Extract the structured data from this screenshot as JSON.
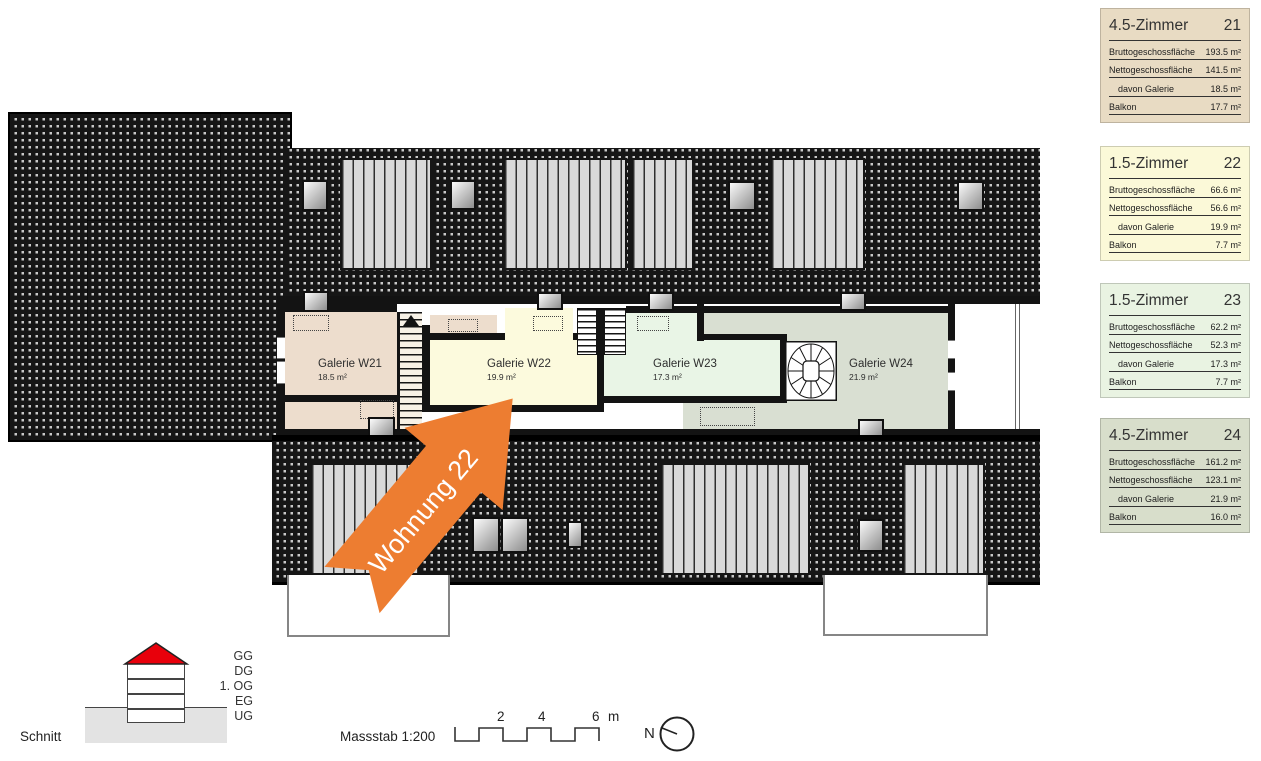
{
  "plan": {
    "galleries": [
      {
        "name": "Galerie W21",
        "area": "18.5 m²",
        "color": "#edddcd"
      },
      {
        "name": "Galerie W22",
        "area": "19.9 m²",
        "color": "#fcfadd"
      },
      {
        "name": "Galerie W23",
        "area": "17.3 m²",
        "color": "#e9f5e6"
      },
      {
        "name": "Galerie W24",
        "area": "21.9 m²",
        "color": "#d9dfd2"
      }
    ],
    "arrow": {
      "label": "Wohnung 22",
      "color": "#ED7D31"
    }
  },
  "cards": [
    {
      "type": "4.5-Zimmer",
      "number": "21",
      "bg": "#e8dbc3",
      "rows": [
        {
          "label": "Bruttogeschossfläche",
          "value": "193.5 m²"
        },
        {
          "label": "Nettogeschossfläche",
          "value": "141.5 m²"
        },
        {
          "label": "davon Galerie",
          "value": "18.5 m²"
        },
        {
          "label": "Balkon",
          "value": "17.7 m²"
        }
      ]
    },
    {
      "type": "1.5-Zimmer",
      "number": "22",
      "bg": "#fbf9d8",
      "rows": [
        {
          "label": "Bruttogeschossfläche",
          "value": "66.6 m²"
        },
        {
          "label": "Nettogeschossfläche",
          "value": "56.6 m²"
        },
        {
          "label": "davon Galerie",
          "value": "19.9 m²"
        },
        {
          "label": "Balkon",
          "value": "7.7 m²"
        }
      ]
    },
    {
      "type": "1.5-Zimmer",
      "number": "23",
      "bg": "#e9f3e2",
      "rows": [
        {
          "label": "Bruttogeschossfläche",
          "value": "62.2 m²"
        },
        {
          "label": "Nettogeschossfläche",
          "value": "52.3 m²"
        },
        {
          "label": "davon Galerie",
          "value": "17.3 m²"
        },
        {
          "label": "Balkon",
          "value": "7.7 m²"
        }
      ]
    },
    {
      "type": "4.5-Zimmer",
      "number": "24",
      "bg": "#d8decb",
      "rows": [
        {
          "label": "Bruttogeschossfläche",
          "value": "161.2 m²"
        },
        {
          "label": "Nettogeschossfläche",
          "value": "123.1 m²"
        },
        {
          "label": "davon Galerie",
          "value": "21.9 m²"
        },
        {
          "label": "Balkon",
          "value": "16.0 m²"
        }
      ]
    }
  ],
  "legend": {
    "section_label": "Schnitt",
    "levels": [
      "GG",
      "DG",
      "1. OG",
      "EG",
      "UG"
    ],
    "scale_label": "Massstab 1:200",
    "scale_ticks": [
      "2",
      "4",
      "6"
    ],
    "scale_unit": "m",
    "north_label": "N",
    "roof_highlight_color": "#e8000b"
  }
}
